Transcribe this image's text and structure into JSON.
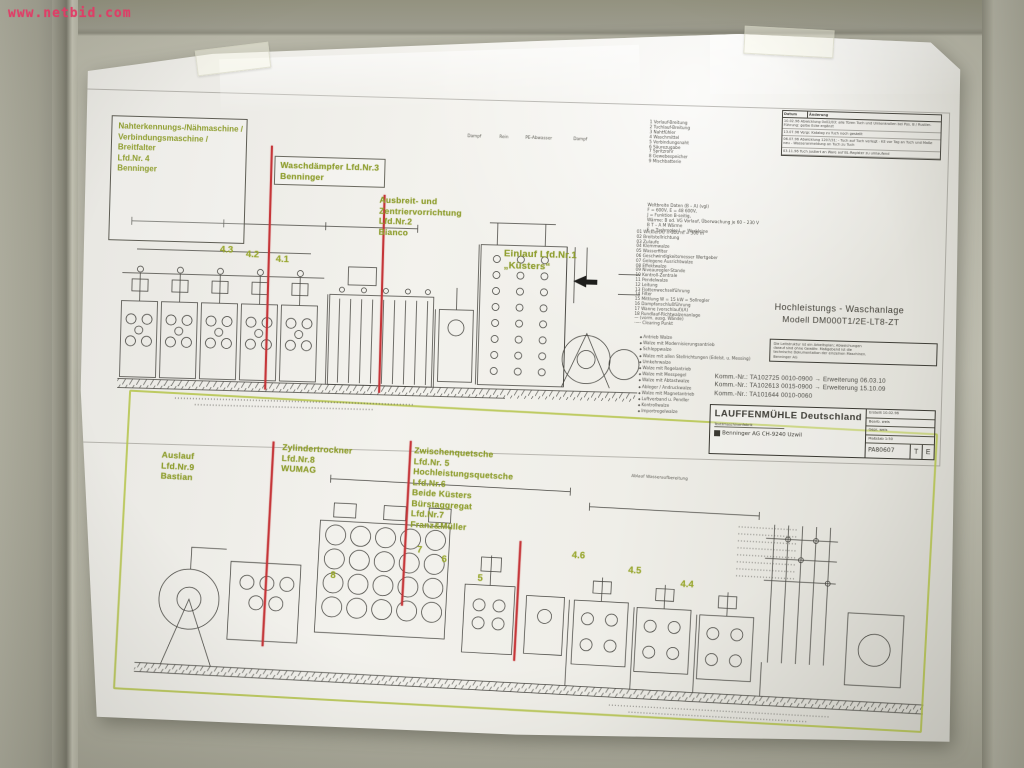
{
  "watermark": "www.netbid.com",
  "colors": {
    "label_green": "#8f9e2f",
    "marker_red": "#c53538",
    "highlight_green": "#b5c44a",
    "watermark_red": "#e23b66"
  },
  "upper": {
    "seam_box": {
      "lines": [
        "Nahterkennungs-/Nähmaschine /",
        "Verbindungsmaschine /",
        "Breitfalter",
        "Lfd.Nr. 4",
        "Benninger"
      ]
    },
    "waschdaempfer": {
      "lines": [
        "Waschdämpfer Lfd.Nr.3",
        "Benninger"
      ]
    },
    "ausbreit": {
      "lines": [
        "Ausbreit- und",
        "Zentriervorrichtung",
        "Lfd.Nr.2",
        "Bianco"
      ]
    },
    "einlauf": {
      "lines": [
        "Einlauf Lfd.Nr.1",
        "„Küsters“"
      ]
    },
    "numbers": [
      "4.3",
      "4.2",
      "4.1"
    ],
    "top_marks": [
      "Dampf",
      "Rein",
      "PE-Abwasser",
      "Dampf"
    ]
  },
  "lower": {
    "auslauf": {
      "lines": [
        "Auslauf",
        "Lfd.Nr.9",
        "Bastian"
      ]
    },
    "zylindertrockner": {
      "lines": [
        "Zylindertrockner",
        "Lfd.Nr.8",
        "WUMAG"
      ]
    },
    "zwischenquetsche": {
      "lines": [
        "Zwischenquetsche",
        "Lfd.Nr. 5",
        "Hochleistungsquetsche",
        "Lfd.Nr.6",
        "Beide Küsters",
        "Bürstaggregat",
        "Lfd.Nr.7",
        "Franz&Müller"
      ]
    },
    "numbers": [
      "8",
      "7",
      "6",
      "5",
      "4.6",
      "4.5",
      "4.4"
    ],
    "ablauf_label": "Ablauf  Wasseraufbereitung"
  },
  "titlearea": {
    "revision": {
      "header": [
        "Datum",
        "Änderung"
      ],
      "rows": [
        "10.02.96  Abwicklung 0x02/03: alle Türen Tuch und Umlenkrollen bei Pos. B / Rustler-Führung: gelbe Ecke ergänzt",
        "13.07.96  Vergr. Katalog zu Tuch noch gestellt",
        "06.07.96  Abwicklung 1207/31: - Tuch auf Tuch verlegt - KE vor Tag an Tuch und Maße neu - Wasseranmeldung an Tuch zu Tuch",
        "03.11.96  Tuch justiert an Ware auf BL-Register zu umlaufend"
      ]
    },
    "model_line1": "Hochleistungs - Waschanlage",
    "model_line2": "Modell  DM000T1/2E-LT8-ZT",
    "note_box": [
      "Die Leitstruktur ist ein Arbeitsplan; Abweichungen",
      "darauf sind ohne Gewähr. Maßgebend ist die",
      "technische Dokumentation der einzelnen Maschinen.",
      "Benninger AG"
    ],
    "komm": [
      "Komm.-Nr.: TA102725  0010-0900   →  Erweiterung 06.03.10",
      "Komm.-Nr.: TA102613  0015-0900   →  Erweiterung 15.10.09",
      "Komm.-Nr.: TA101644  0010-0060"
    ],
    "company": "LAUFFENMÜHLE  Deutschland",
    "company_sub": "Textilmaschinenfabrik",
    "manufacturer": "Benninger AG   CH-9240 Uzwil",
    "info_rows": [
      "Erstellt   10.02.96",
      "Bearb.    weis",
      "Gepr.     weis",
      "Maßstab  1:50"
    ],
    "drawing_no": "PA80607",
    "corner_cells": [
      "T",
      "E"
    ]
  },
  "legend": {
    "list1": [
      "1  Vorlauf-Breitung",
      "2  Tuchlauf-Breitung",
      "3  Nahtfühler",
      "4  Waschmittel",
      "5  Verbindungsnaht",
      "6  Säurezugabe",
      "7  Spritzrohr",
      "8  Gewebespeicher",
      "9  Mischbatterie"
    ],
    "notes": [
      "Weltbreite Daten  (B – A)  (vgl)",
      "F = 600V,  E = 48 600V,",
      "J = Funktion B-seitig,",
      "Wärme: B od. VG Vorlauf, Überwachung je 60 – 230 V",
      "B T – A M    Wärme",
      "E = Tuchregler    L = Werkleine"
    ],
    "list2": [
      "01  Wickler(A)  = 300 m = 300 m",
      "02  Breitstellrichtung",
      "03  Zulaufe",
      "04  Klemmwalze",
      "05  Wasserfilter",
      "06  Geschwindigkeitsmesser Wertgeber",
      "07  Gelegene Ausrichtwalze",
      "08  Effektwalze",
      "09  Niveauregler-Stande",
      "10  Kontroll-Zentrale",
      "11  Pendelwalze",
      "12  Leitung",
      "13  Flottenwechselführung",
      "14  Filter",
      "15  Mittlung  W = 15 kW = Sollregler",
      "16  Dampfanschlußführung",
      "17  Wanne (vorschlauf)(A)",
      "18  Rundlauf-Richtwalzenanlage",
      "—   (vorm. ausg. Wände)",
      "·—·  Clearing Punkt"
    ],
    "list3": [
      "Antrieb Walze",
      "Walze mit Modernisierungsantrieb",
      "Schleppwalze",
      "Walze mit allen Stellrichtungen (Edelst. u. Messing)",
      "Umkehrwalze",
      "Walze mit Regelantrieb",
      "Walze mit Messpegel",
      "Walze mit Abtastwalze",
      "Ableger / Andruckwalze",
      "Walze mit Magnetantrieb",
      "Luftverband u. Pendler",
      "Kontrollwalze",
      "Importregelwalze"
    ]
  }
}
